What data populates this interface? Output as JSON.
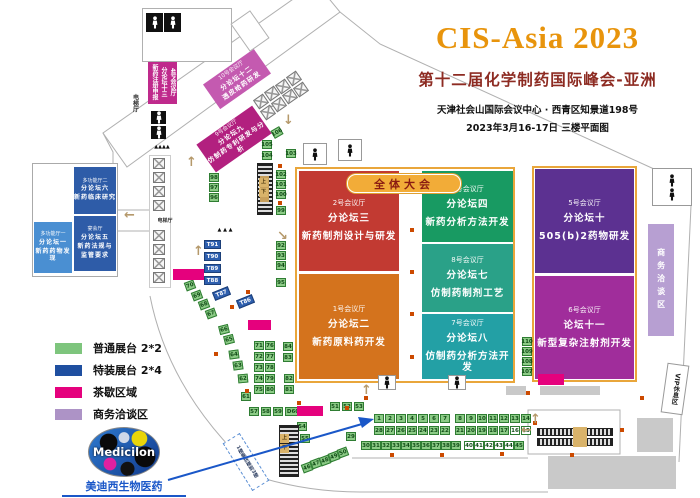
{
  "header": {
    "title": "CIS-Asia 2023",
    "subtitle": "第十二届化学制药国际峰会-亚洲",
    "address": "天津社会山国际会议中心 · 西青区知景道198号",
    "date_floor": "2023年3月16-17日   三楼平面图"
  },
  "banner": {
    "label": "全体大会"
  },
  "logo": {
    "name": "Medicilon",
    "company": "美迪西生物医药"
  },
  "legend": [
    {
      "label": "普通展台 2*2",
      "color": "#7ec57d"
    },
    {
      "label": "特装展台 2*4",
      "color": "#1f4fa0"
    },
    {
      "label": "茶歇区域",
      "color": "#e5017d"
    },
    {
      "label": "商务洽谈区",
      "color": "#ad93c6"
    }
  ],
  "halls": [
    {
      "key": "2",
      "x": 299,
      "y": 171,
      "w": 100,
      "h": 100,
      "color": "#c23a32",
      "lines": [
        "2号会议厅",
        "分论坛三",
        "新药制剂设计与研发"
      ]
    },
    {
      "key": "1",
      "x": 299,
      "y": 274,
      "w": 100,
      "h": 105,
      "color": "#d4731d",
      "lines": [
        "1号会议厅",
        "分论坛二",
        "新药原料药开发"
      ]
    },
    {
      "key": "3",
      "x": 422,
      "y": 171,
      "w": 91,
      "h": 71,
      "color": "#189a62",
      "lines": [
        "3号会议厅",
        "分论坛四",
        "新药分析方法开发"
      ]
    },
    {
      "key": "8",
      "x": 422,
      "y": 244,
      "w": 91,
      "h": 68,
      "color": "#2aa188",
      "lines": [
        "8号会议厅",
        "分论坛七",
        "仿制药制剂工艺"
      ]
    },
    {
      "key": "7",
      "x": 422,
      "y": 314,
      "w": 91,
      "h": 65,
      "color": "#23a0a5",
      "lines": [
        "7号会议厅",
        "分论坛八",
        "仿制药分析方法开发"
      ]
    },
    {
      "key": "5",
      "x": 535,
      "y": 169,
      "w": 99,
      "h": 104,
      "color": "#5c3191",
      "lines": [
        "5号会议厅",
        "分论坛十",
        "505(b)2药物研发"
      ]
    },
    {
      "key": "6",
      "x": 535,
      "y": 276,
      "w": 99,
      "h": 103,
      "color": "#a02d9b",
      "lines": [
        "6号会议厅",
        "论坛十一",
        "新型复杂注射剂开发"
      ]
    },
    {
      "key": "mf2",
      "x": 74,
      "y": 167,
      "w": 42,
      "h": 47,
      "color": "#2e5ca8",
      "fs": 6,
      "lines": [
        "多功能厅二",
        "分论坛六",
        "新药临床研究"
      ]
    },
    {
      "key": "banquet",
      "x": 74,
      "y": 216,
      "w": 42,
      "h": 55,
      "color": "#2e5ca8",
      "fs": 6,
      "lines": [
        "宴会厅",
        "分论坛五",
        "新药法规与",
        "监管要求"
      ]
    },
    {
      "key": "mf1",
      "x": 34,
      "y": 222,
      "w": 38,
      "h": 51,
      "color": "#4a8fd2",
      "fs": 6,
      "lines": [
        "多功能厅一",
        "分论坛一",
        "新药药物发现"
      ]
    },
    {
      "key": "10",
      "x": 206,
      "y": 64,
      "w": 62,
      "h": 30,
      "color": "#c45ab0",
      "fs": 6.5,
      "rot": -35,
      "lines": [
        "10号会议厅",
        "分论坛十二",
        "透皮给药研发"
      ]
    },
    {
      "key": "9",
      "x": 200,
      "y": 122,
      "w": 68,
      "h": 34,
      "color": "#b2207f",
      "fs": 6.5,
      "rot": -35,
      "lines": [
        "9号会议厅",
        "分论坛九",
        "仿制药专利研发与分析"
      ]
    },
    {
      "key": "4",
      "x": 148,
      "y": 57,
      "w": 29,
      "h": 47,
      "color": "#bf2a8c",
      "fs": 6,
      "vert": true,
      "lines": [
        "4号会议厅",
        "分论坛十三",
        "新药注册申报"
      ]
    }
  ],
  "booths": [
    {
      "n": "1",
      "x": 374,
      "y": 414
    },
    {
      "n": "2",
      "x": 385,
      "y": 414
    },
    {
      "n": "3",
      "x": 396,
      "y": 414
    },
    {
      "n": "4",
      "x": 407,
      "y": 414
    },
    {
      "n": "5",
      "x": 418,
      "y": 414
    },
    {
      "n": "6",
      "x": 429,
      "y": 414
    },
    {
      "n": "7",
      "x": 440,
      "y": 414
    },
    {
      "n": "8",
      "x": 455,
      "y": 414
    },
    {
      "n": "9",
      "x": 466,
      "y": 414
    },
    {
      "n": "10",
      "x": 477,
      "y": 414
    },
    {
      "n": "11",
      "x": 488,
      "y": 414
    },
    {
      "n": "12",
      "x": 499,
      "y": 414
    },
    {
      "n": "13",
      "x": 510,
      "y": 414
    },
    {
      "n": "14",
      "x": 521,
      "y": 414
    },
    {
      "n": "28",
      "x": 374,
      "y": 426
    },
    {
      "n": "27",
      "x": 385,
      "y": 426
    },
    {
      "n": "26",
      "x": 396,
      "y": 426
    },
    {
      "n": "25",
      "x": 407,
      "y": 426
    },
    {
      "n": "24",
      "x": 418,
      "y": 426
    },
    {
      "n": "23",
      "x": 429,
      "y": 426
    },
    {
      "n": "22",
      "x": 440,
      "y": 426
    },
    {
      "n": "21",
      "x": 455,
      "y": 426
    },
    {
      "n": "20",
      "x": 466,
      "y": 426
    },
    {
      "n": "19",
      "x": 477,
      "y": 426
    },
    {
      "n": "18",
      "x": 488,
      "y": 426
    },
    {
      "n": "17",
      "x": 499,
      "y": 426
    },
    {
      "n": "16",
      "x": 510,
      "y": 426,
      "t": "w"
    },
    {
      "n": "15",
      "x": 521,
      "y": 426,
      "t": "w"
    },
    {
      "n": "30",
      "x": 361,
      "y": 441
    },
    {
      "n": "31",
      "x": 371,
      "y": 441
    },
    {
      "n": "32",
      "x": 381,
      "y": 441
    },
    {
      "n": "33",
      "x": 391,
      "y": 441
    },
    {
      "n": "34",
      "x": 401,
      "y": 441
    },
    {
      "n": "35",
      "x": 411,
      "y": 441
    },
    {
      "n": "36",
      "x": 421,
      "y": 441
    },
    {
      "n": "37",
      "x": 431,
      "y": 441
    },
    {
      "n": "38",
      "x": 441,
      "y": 441
    },
    {
      "n": "39",
      "x": 451,
      "y": 441
    },
    {
      "n": "40",
      "x": 464,
      "y": 441,
      "t": "w"
    },
    {
      "n": "41",
      "x": 474,
      "y": 441,
      "t": "w"
    },
    {
      "n": "42",
      "x": 484,
      "y": 441,
      "t": "w"
    },
    {
      "n": "43",
      "x": 494,
      "y": 441,
      "t": "w"
    },
    {
      "n": "44",
      "x": 504,
      "y": 441,
      "t": "w"
    },
    {
      "n": "45",
      "x": 514,
      "y": 441
    },
    {
      "n": "29",
      "x": 346,
      "y": 432
    },
    {
      "n": "70",
      "x": 185,
      "y": 281,
      "r": -20
    },
    {
      "n": "69",
      "x": 192,
      "y": 291,
      "r": -20
    },
    {
      "n": "68",
      "x": 199,
      "y": 300,
      "r": -20
    },
    {
      "n": "67",
      "x": 206,
      "y": 309,
      "r": -20
    },
    {
      "n": "66",
      "x": 219,
      "y": 325,
      "r": -14
    },
    {
      "n": "65",
      "x": 224,
      "y": 335,
      "r": -14
    },
    {
      "n": "64",
      "x": 229,
      "y": 350,
      "r": -8
    },
    {
      "n": "63",
      "x": 233,
      "y": 361,
      "r": -8
    },
    {
      "n": "62",
      "x": 238,
      "y": 374,
      "r": -5
    },
    {
      "n": "61",
      "x": 241,
      "y": 392
    },
    {
      "n": "57",
      "x": 249,
      "y": 407
    },
    {
      "n": "58",
      "x": 261,
      "y": 407
    },
    {
      "n": "59",
      "x": 273,
      "y": 407
    },
    {
      "n": "D60",
      "x": 285,
      "y": 407,
      "w": 16
    },
    {
      "n": "51",
      "x": 330,
      "y": 402
    },
    {
      "n": "52",
      "x": 342,
      "y": 402
    },
    {
      "n": "53",
      "x": 354,
      "y": 402
    },
    {
      "n": "54",
      "x": 297,
      "y": 422
    },
    {
      "n": "55",
      "x": 300,
      "y": 434
    },
    {
      "n": "46",
      "x": 302,
      "y": 463,
      "r": -20
    },
    {
      "n": "47",
      "x": 311,
      "y": 459,
      "r": -20
    },
    {
      "n": "48",
      "x": 320,
      "y": 456,
      "r": -20
    },
    {
      "n": "49",
      "x": 329,
      "y": 452,
      "r": -20
    },
    {
      "n": "50",
      "x": 338,
      "y": 448,
      "r": -20
    },
    {
      "n": "71",
      "x": 254,
      "y": 341
    },
    {
      "n": "76",
      "x": 265,
      "y": 341
    },
    {
      "n": "72",
      "x": 254,
      "y": 352
    },
    {
      "n": "77",
      "x": 265,
      "y": 352
    },
    {
      "n": "73",
      "x": 254,
      "y": 363
    },
    {
      "n": "78",
      "x": 265,
      "y": 363
    },
    {
      "n": "74",
      "x": 254,
      "y": 374
    },
    {
      "n": "79",
      "x": 265,
      "y": 374
    },
    {
      "n": "75",
      "x": 254,
      "y": 385
    },
    {
      "n": "80",
      "x": 265,
      "y": 385
    },
    {
      "n": "84",
      "x": 283,
      "y": 342
    },
    {
      "n": "83",
      "x": 283,
      "y": 353
    },
    {
      "n": "82",
      "x": 284,
      "y": 374
    },
    {
      "n": "81",
      "x": 284,
      "y": 385
    },
    {
      "n": "92",
      "x": 276,
      "y": 241
    },
    {
      "n": "93",
      "x": 276,
      "y": 251
    },
    {
      "n": "94",
      "x": 276,
      "y": 261
    },
    {
      "n": "95",
      "x": 276,
      "y": 278
    },
    {
      "n": "98",
      "x": 209,
      "y": 173
    },
    {
      "n": "97",
      "x": 209,
      "y": 183
    },
    {
      "n": "96",
      "x": 209,
      "y": 193
    },
    {
      "n": "102",
      "x": 276,
      "y": 170
    },
    {
      "n": "101",
      "x": 276,
      "y": 180
    },
    {
      "n": "100",
      "x": 276,
      "y": 190
    },
    {
      "n": "99",
      "x": 276,
      "y": 206
    },
    {
      "n": "103",
      "x": 286,
      "y": 149
    },
    {
      "n": "104",
      "x": 262,
      "y": 151
    },
    {
      "n": "105",
      "x": 262,
      "y": 140
    },
    {
      "n": "106",
      "x": 272,
      "y": 128,
      "r": -30
    },
    {
      "n": "110",
      "x": 522,
      "y": 337
    },
    {
      "n": "109",
      "x": 522,
      "y": 347
    },
    {
      "n": "108",
      "x": 522,
      "y": 357
    },
    {
      "n": "107",
      "x": 522,
      "y": 367
    },
    {
      "n": "T91",
      "x": 204,
      "y": 240,
      "t": "t"
    },
    {
      "n": "T90",
      "x": 204,
      "y": 252,
      "t": "t"
    },
    {
      "n": "T89",
      "x": 204,
      "y": 264,
      "t": "t"
    },
    {
      "n": "T88",
      "x": 204,
      "y": 276,
      "t": "t"
    },
    {
      "n": "T87",
      "x": 213,
      "y": 289,
      "t": "t",
      "r": -22
    },
    {
      "n": "T86",
      "x": 237,
      "y": 297,
      "t": "t",
      "r": -22
    }
  ],
  "labels": [
    {
      "id": "elevator-block-bg",
      "t": "",
      "x": 142,
      "y": 8,
      "w": 90,
      "h": 54,
      "bg": "#ffffff",
      "border": "solid",
      "bcolor": "#b0b0b0"
    },
    {
      "id": "stair-box",
      "t": "",
      "x": 238,
      "y": 14,
      "w": 24,
      "h": 34,
      "bg": "#ffffff",
      "border": "solid",
      "bcolor": "#b0b0b0",
      "rot": -35
    },
    {
      "id": "elevator-bank-bg",
      "t": "",
      "x": 149,
      "y": 155,
      "w": 22,
      "h": 133,
      "bg": "#ffffff",
      "border": "solid",
      "bcolor": "#cccccc"
    },
    {
      "id": "gray-block",
      "t": "",
      "x": 548,
      "y": 456,
      "w": 128,
      "h": 33,
      "bg": "#c9c9c9"
    },
    {
      "id": "gray-block",
      "t": "",
      "x": 637,
      "y": 418,
      "w": 36,
      "h": 34,
      "bg": "#c9c9c9"
    },
    {
      "id": "gray-block",
      "t": "",
      "x": 540,
      "y": 386,
      "w": 60,
      "h": 9,
      "bg": "#c9c9c9"
    },
    {
      "id": "gray-block",
      "t": "",
      "x": 506,
      "y": 386,
      "w": 20,
      "h": 9,
      "bg": "#c9c9c9"
    },
    {
      "id": "escalator",
      "t": "",
      "x": 279,
      "y": 425,
      "w": 20,
      "h": 52,
      "cls": "esc-v"
    },
    {
      "id": "stairway",
      "t": "",
      "x": 257,
      "y": 163,
      "w": 16,
      "h": 52,
      "cls": "esc-v"
    },
    {
      "id": "stairway-center",
      "t": "",
      "x": 260,
      "y": 176,
      "w": 9,
      "h": 26,
      "bg": "#c8a05c"
    },
    {
      "id": "escalator",
      "t": "",
      "x": 537,
      "y": 428,
      "w": 76,
      "h": 8,
      "cls": "esc-h"
    },
    {
      "id": "escalator",
      "t": "",
      "x": 537,
      "y": 438,
      "w": 76,
      "h": 8,
      "cls": "esc-h"
    },
    {
      "id": "escalator-center",
      "t": "",
      "x": 573,
      "y": 427,
      "w": 14,
      "h": 20,
      "bg": "#d9b36a"
    },
    {
      "id": "tea-break-area",
      "t": "",
      "x": 173,
      "y": 269,
      "w": 31,
      "h": 11,
      "bg": "#e5017d"
    },
    {
      "id": "tea-break-area",
      "t": "",
      "x": 248,
      "y": 320,
      "w": 23,
      "h": 10,
      "bg": "#e5017d"
    },
    {
      "id": "tea-break-area",
      "t": "",
      "x": 297,
      "y": 406,
      "w": 26,
      "h": 10,
      "bg": "#e5017d"
    },
    {
      "id": "tea-break-area",
      "t": "",
      "x": 538,
      "y": 374,
      "w": 26,
      "h": 11,
      "bg": "#e5017d"
    },
    {
      "id": "business-zone",
      "t": "商务洽谈区",
      "x": 648,
      "y": 224,
      "w": 26,
      "h": 112,
      "bg": "#b79fd2",
      "color": "#ffffff",
      "vert": true,
      "fs": 8,
      "ls": 5
    },
    {
      "id": "vip-lounge",
      "t": "VIP休息区",
      "x": 664,
      "y": 364,
      "w": 22,
      "h": 50,
      "bg": "#ffffff",
      "border": "solid",
      "bcolor": "#999999",
      "vert": true,
      "fs": 6.5,
      "rot": 8,
      "color": "#222222"
    },
    {
      "id": "escalator-note",
      "t": "1楼乘扶梯到3楼",
      "x": 236,
      "y": 434,
      "w": 20,
      "h": 56,
      "bg": "#ffffff",
      "border": "dashed",
      "bcolor": "#5b8fd4",
      "vert": true,
      "fs": 5,
      "rot": -32,
      "color": "#334466"
    },
    {
      "id": "elevator-hall-label",
      "t": "电梯厅",
      "x": 129,
      "y": 90,
      "w": 10,
      "h": 26,
      "vert": true,
      "fs": 6,
      "color": "#333333"
    },
    {
      "id": "elevator-hall-label",
      "t": "电梯厅",
      "x": 155,
      "y": 218,
      "w": 20,
      "h": 7,
      "fs": 5,
      "color": "#333333"
    },
    {
      "id": "dining-label",
      "t": "小餐厅",
      "x": 266,
      "y": 102,
      "w": 18,
      "h": 8,
      "fs": 4.5,
      "rot": -35,
      "color": "#444444"
    },
    {
      "id": "stair-marks",
      "t": "▲▲▲▲",
      "x": 145,
      "y": 144,
      "w": 34,
      "h": 8,
      "fs": 5,
      "color": "#111111"
    },
    {
      "id": "stair-marks",
      "t": "▲ ▲ ▲",
      "x": 211,
      "y": 227,
      "w": 28,
      "h": 8,
      "fs": 5,
      "color": "#111111"
    },
    {
      "id": "esc-up-label",
      "t": "上",
      "x": 280,
      "y": 434,
      "w": 9,
      "h": 9,
      "bg": "#d9b36a",
      "fs": 5,
      "color": "#4f3a10"
    },
    {
      "id": "esc-down-label",
      "t": "下",
      "x": 280,
      "y": 444,
      "w": 9,
      "h": 9,
      "bg": "#d9b36a",
      "fs": 5,
      "color": "#4f3a10"
    },
    {
      "id": "esc-up-label",
      "t": "上",
      "x": 259,
      "y": 178,
      "w": 9,
      "h": 9,
      "bg": "#d9b36a",
      "fs": 5,
      "color": "#4f3a10"
    },
    {
      "id": "esc-down-label",
      "t": "下",
      "x": 259,
      "y": 188,
      "w": 9,
      "h": 9,
      "bg": "#d9b36a",
      "fs": 5,
      "color": "#4f3a10"
    }
  ],
  "xboxes": [
    {
      "x": 255,
      "y": 96
    },
    {
      "x": 266,
      "y": 88
    },
    {
      "x": 277,
      "y": 81
    },
    {
      "x": 288,
      "y": 73
    },
    {
      "x": 262,
      "y": 107
    },
    {
      "x": 273,
      "y": 99
    },
    {
      "x": 284,
      "y": 91
    },
    {
      "x": 295,
      "y": 84
    },
    {
      "x": 153,
      "y": 158,
      "r": 0
    },
    {
      "x": 153,
      "y": 172,
      "r": 0
    },
    {
      "x": 153,
      "y": 186,
      "r": 0
    },
    {
      "x": 153,
      "y": 200,
      "r": 0
    },
    {
      "x": 153,
      "y": 230,
      "r": 0
    },
    {
      "x": 153,
      "y": 244,
      "r": 0
    },
    {
      "x": 153,
      "y": 258,
      "r": 0
    },
    {
      "x": 153,
      "y": 272,
      "r": 0
    }
  ],
  "eboxes": [
    {
      "x": 652,
      "y": 168,
      "w": 40,
      "h": 38,
      "p": 2,
      "col": true
    },
    {
      "x": 303,
      "y": 143,
      "w": 24,
      "h": 22,
      "p": 1
    },
    {
      "x": 338,
      "y": 139,
      "w": 24,
      "h": 22,
      "p": 1
    },
    {
      "x": 378,
      "y": 375,
      "w": 18,
      "h": 15,
      "p": 1
    },
    {
      "x": 448,
      "y": 375,
      "w": 18,
      "h": 15,
      "p": 1
    },
    {
      "x": 146,
      "y": 13,
      "w": 17,
      "h": 19,
      "p": 1,
      "dark": true
    },
    {
      "x": 164,
      "y": 13,
      "w": 17,
      "h": 19,
      "p": 1,
      "dark": true
    },
    {
      "x": 151,
      "y": 111,
      "w": 15,
      "h": 13,
      "p": 1,
      "dark": true
    },
    {
      "x": 151,
      "y": 126,
      "w": 15,
      "h": 13,
      "p": 1,
      "dark": true
    }
  ],
  "dots": [
    [
      410,
      182
    ],
    [
      410,
      228
    ],
    [
      410,
      270
    ],
    [
      410,
      312
    ],
    [
      410,
      355
    ],
    [
      278,
      164
    ],
    [
      278,
      201
    ],
    [
      246,
      290
    ],
    [
      230,
      305
    ],
    [
      214,
      352
    ],
    [
      245,
      389
    ],
    [
      297,
      401
    ],
    [
      345,
      406
    ],
    [
      364,
      396
    ],
    [
      390,
      453
    ],
    [
      440,
      453
    ],
    [
      500,
      452
    ],
    [
      526,
      391
    ],
    [
      533,
      421
    ],
    [
      570,
      453
    ],
    [
      620,
      428
    ],
    [
      640,
      396
    ]
  ],
  "arrows": [
    {
      "g": "↑",
      "x": 186,
      "y": 156
    },
    {
      "g": "↑",
      "x": 193,
      "y": 245
    },
    {
      "g": "↓",
      "x": 283,
      "y": 114
    },
    {
      "g": "↘",
      "x": 277,
      "y": 230
    },
    {
      "g": "↑",
      "x": 361,
      "y": 384
    },
    {
      "g": "↑",
      "x": 530,
      "y": 413
    },
    {
      "g": "←",
      "x": 521,
      "y": 424
    },
    {
      "g": "←",
      "x": 124,
      "y": 209
    }
  ]
}
